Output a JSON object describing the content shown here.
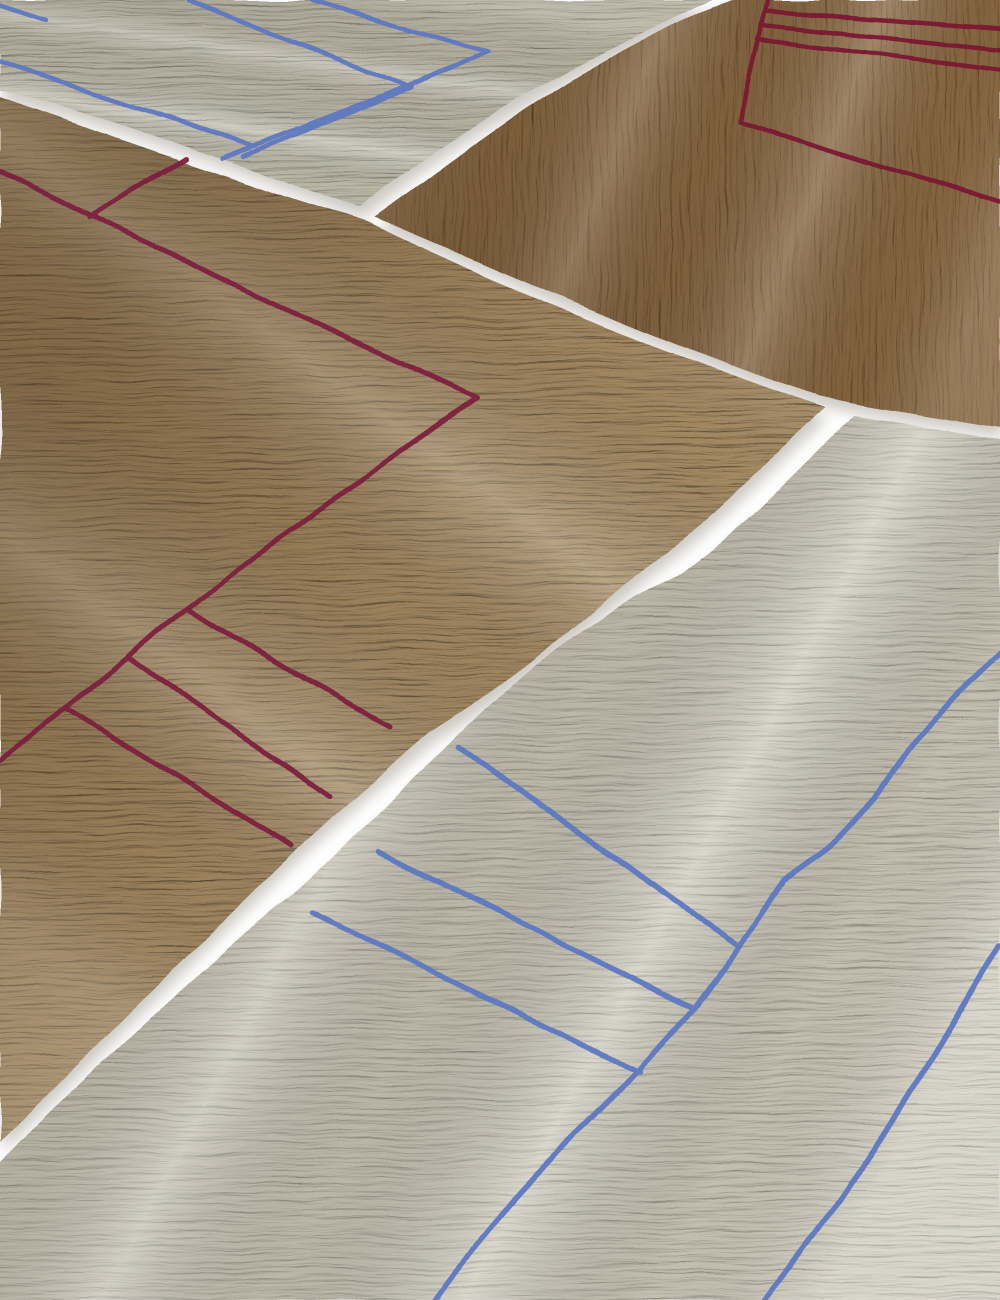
{
  "scene": {
    "description": "Overhead photograph of four overlapping minimalist hand-tufted rugs arranged diagonally on a white floor. A greige rug with cobalt blue corner lines sits top-left, a dark tan rug with burgundy rung lines sits top-right, a large beige rug with a burgundy rectangle and three burgundy stripes fills the center-left, and a cream rug with long blue lines and three blue stripes fills the bottom-right. Narrow strips of white floor separate the rugs.",
    "background_color": "#ffffff",
    "width": 1000,
    "height": 1300,
    "shadow": {
      "color": "#7a7161",
      "opacity": 0.38,
      "blur": 7,
      "dx": 3,
      "dy": 10
    },
    "rugs": [
      {
        "id": "rug-greige-top-left",
        "name": "greige rug with blue line pattern",
        "base_color": "#c4c1b0",
        "line_color": "#5d77c1",
        "line_width": 4.5,
        "outline": "M0 0 L713 0 C642 34 498 96 360 208 C248 168 118 118 0 90 Z",
        "lines": [
          "M312 0 L487 52 C398 90 300 128 222 158",
          "M187 0 L410 87 C352 112 295 134 243 156",
          "M0 62 C88 91 172 119 252 145",
          "M0 5 L48 20"
        ],
        "weave": {
          "frequency": "0.010 0.28",
          "seed": 11,
          "depth": 1.6
        },
        "sheen": {
          "angle": 118,
          "strength": 0.85
        },
        "shade": {
          "angle": 280,
          "color": "#6e6753",
          "opacity": 0.16
        }
      },
      {
        "id": "rug-brown-top-right",
        "name": "dark tan rug with burgundy line pattern",
        "base_color": "#8d6b44",
        "line_color": "#7a1832",
        "line_width": 4.5,
        "outline": "M733 0 L1000 0 L1000 428 C930 416 868 407 820 396 C675 350 478 260 375 218 C436 176 580 56 733 0 Z",
        "lines": [
          "M768 0 C756 42 747 80 741 122 C828 152 915 177 1000 202",
          "M765 10 C843 16 923 22 1000 28",
          "M761 24 C842 32 923 41 1000 49",
          "M757 38 C838 48 920 59 1000 69"
        ],
        "weave": {
          "frequency": "0.22 0.014",
          "seed": 4,
          "depth": 1.9
        },
        "sheen": {
          "angle": 15,
          "strength": 0.65
        },
        "shade": {
          "angle": 160,
          "color": "#3f2d17",
          "opacity": 0.22
        }
      },
      {
        "id": "rug-beige-center-left",
        "name": "beige rug with burgundy rectangle and stripes",
        "base_color": "#b2976e",
        "line_color": "#7c1f3e",
        "line_width": 5,
        "outline": "M0 97 C128 142 252 186 368 222 C515 295 700 365 825 408 C788 440 718 516 650 565 C560 640 498 692 430 733 C378 778 330 817 283 862 C188 955 92 1050 0 1142 Z",
        "lines": [
          "M0 170 C160 250 330 332 477 397 C420 436 345 492 277 540 C244 563 212 588 185 608 C165 623 146 640 128 657 C107 674 86 691 65 708 C43 726 22 743 0 761",
          "M90 217 L186 158",
          "M185 608 C255 648 323 690 390 726",
          "M128 657 C194 702 262 749 330 796",
          "M65 708 C140 754 214 800 290 846"
        ],
        "weave": {
          "frequency": "0.012 0.26",
          "seed": 7,
          "depth": 2.0
        },
        "sheen": {
          "angle": 120,
          "strength": 0.8
        },
        "shade": {
          "angle": 215,
          "color": "#4c3418",
          "opacity": 0.4
        }
      },
      {
        "id": "rug-cream-bottom-right",
        "name": "cream rug with blue lines and stripes",
        "base_color": "#d0ccbc",
        "line_color": "#5c77c2",
        "line_width": 5.5,
        "outline": "M855 415 C905 423 955 431 1000 440 L1000 1300 L0 1300 L0 1162 C105 1058 205 968 310 878 C358 830 405 790 450 745 C525 670 585 622 670 580 C722 552 812 455 855 415 Z",
        "lines": [
          "M1000 652 C950 698 910 742 874 800 C838 846 806 860 783 880 C752 927 724 968 693 1010 C652 1053 621 1092 580 1132 C528 1182 478 1240 435 1300",
          "M460 748 C550 812 643 878 735 942",
          "M378 852 C482 903 588 956 693 1008",
          "M312 912 C420 966 530 1020 640 1072",
          "M1000 945 C944 1032 878 1162 764 1300"
        ],
        "weave": {
          "frequency": "0.012 0.22",
          "seed": 19,
          "depth": 1.5
        },
        "sheen": {
          "angle": 25,
          "strength": 1.0
        },
        "shade": {
          "angle": 205,
          "color": "#6d6450",
          "opacity": 0.18
        }
      }
    ]
  }
}
